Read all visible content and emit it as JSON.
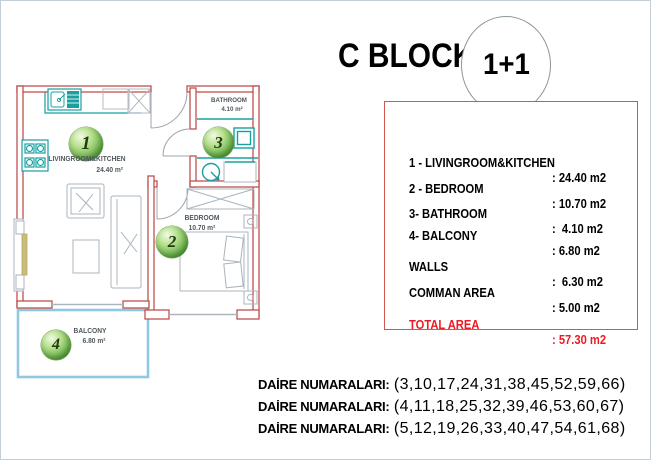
{
  "header": {
    "block_title": "C BLOCK",
    "unit_type": "1+1"
  },
  "floor_plan": {
    "rooms": [
      {
        "number": "1",
        "name": "LIVINGROOM&KITCHEN",
        "area": "24.40 m²"
      },
      {
        "number": "2",
        "name": "BEDROOM",
        "area": "10.70 m²"
      },
      {
        "number": "3",
        "name": "BATHROOM",
        "area": "4.10 m²"
      },
      {
        "number": "4",
        "name": "BALCONY",
        "area": "6.80 m²"
      }
    ]
  },
  "area_table": {
    "rows": [
      {
        "label": "1 - LIVINGROOM&KITCHEN",
        "value": ": 24.40 m2"
      },
      {
        "label": "2 - BEDROOM",
        "value": ": 10.70 m2"
      },
      {
        "label": "3- BATHROOM",
        "value": ":  4.10 m2"
      },
      {
        "label": "4- BALCONY",
        "value": ": 6.80 m2"
      },
      {
        "label": "WALLS",
        "value": ":  6.30 m2"
      },
      {
        "label": "COMMAN AREA",
        "value": ": 5.00 m2"
      }
    ],
    "total_row": {
      "label": "TOTAL AREA",
      "value": ": 57.30 m2"
    }
  },
  "apartment_numbers": {
    "lines": [
      {
        "label": "DAİRE NUMARALARI:",
        "numbers": "(3,10,17,24,31,38,45,52,59,66)"
      },
      {
        "label": "DAİRE NUMARALARI:",
        "numbers": "(4,11,18,25,32,39,46,53,60,67)"
      },
      {
        "label": "DAİRE NUMARALARI:",
        "numbers": "(5,12,19,26,33,40,47,54,61,68)"
      }
    ]
  },
  "colors": {
    "wall_red": "#C0504D",
    "table_border_red": "#D4564E",
    "total_red": "#EC1C24",
    "fixture_teal": "#18A0A0",
    "balcony_blue": "#8FC8DF",
    "furniture_gray": "#A9B4BC",
    "ball_green": "#63AB44",
    "window_tan": "#C9BD7E"
  }
}
